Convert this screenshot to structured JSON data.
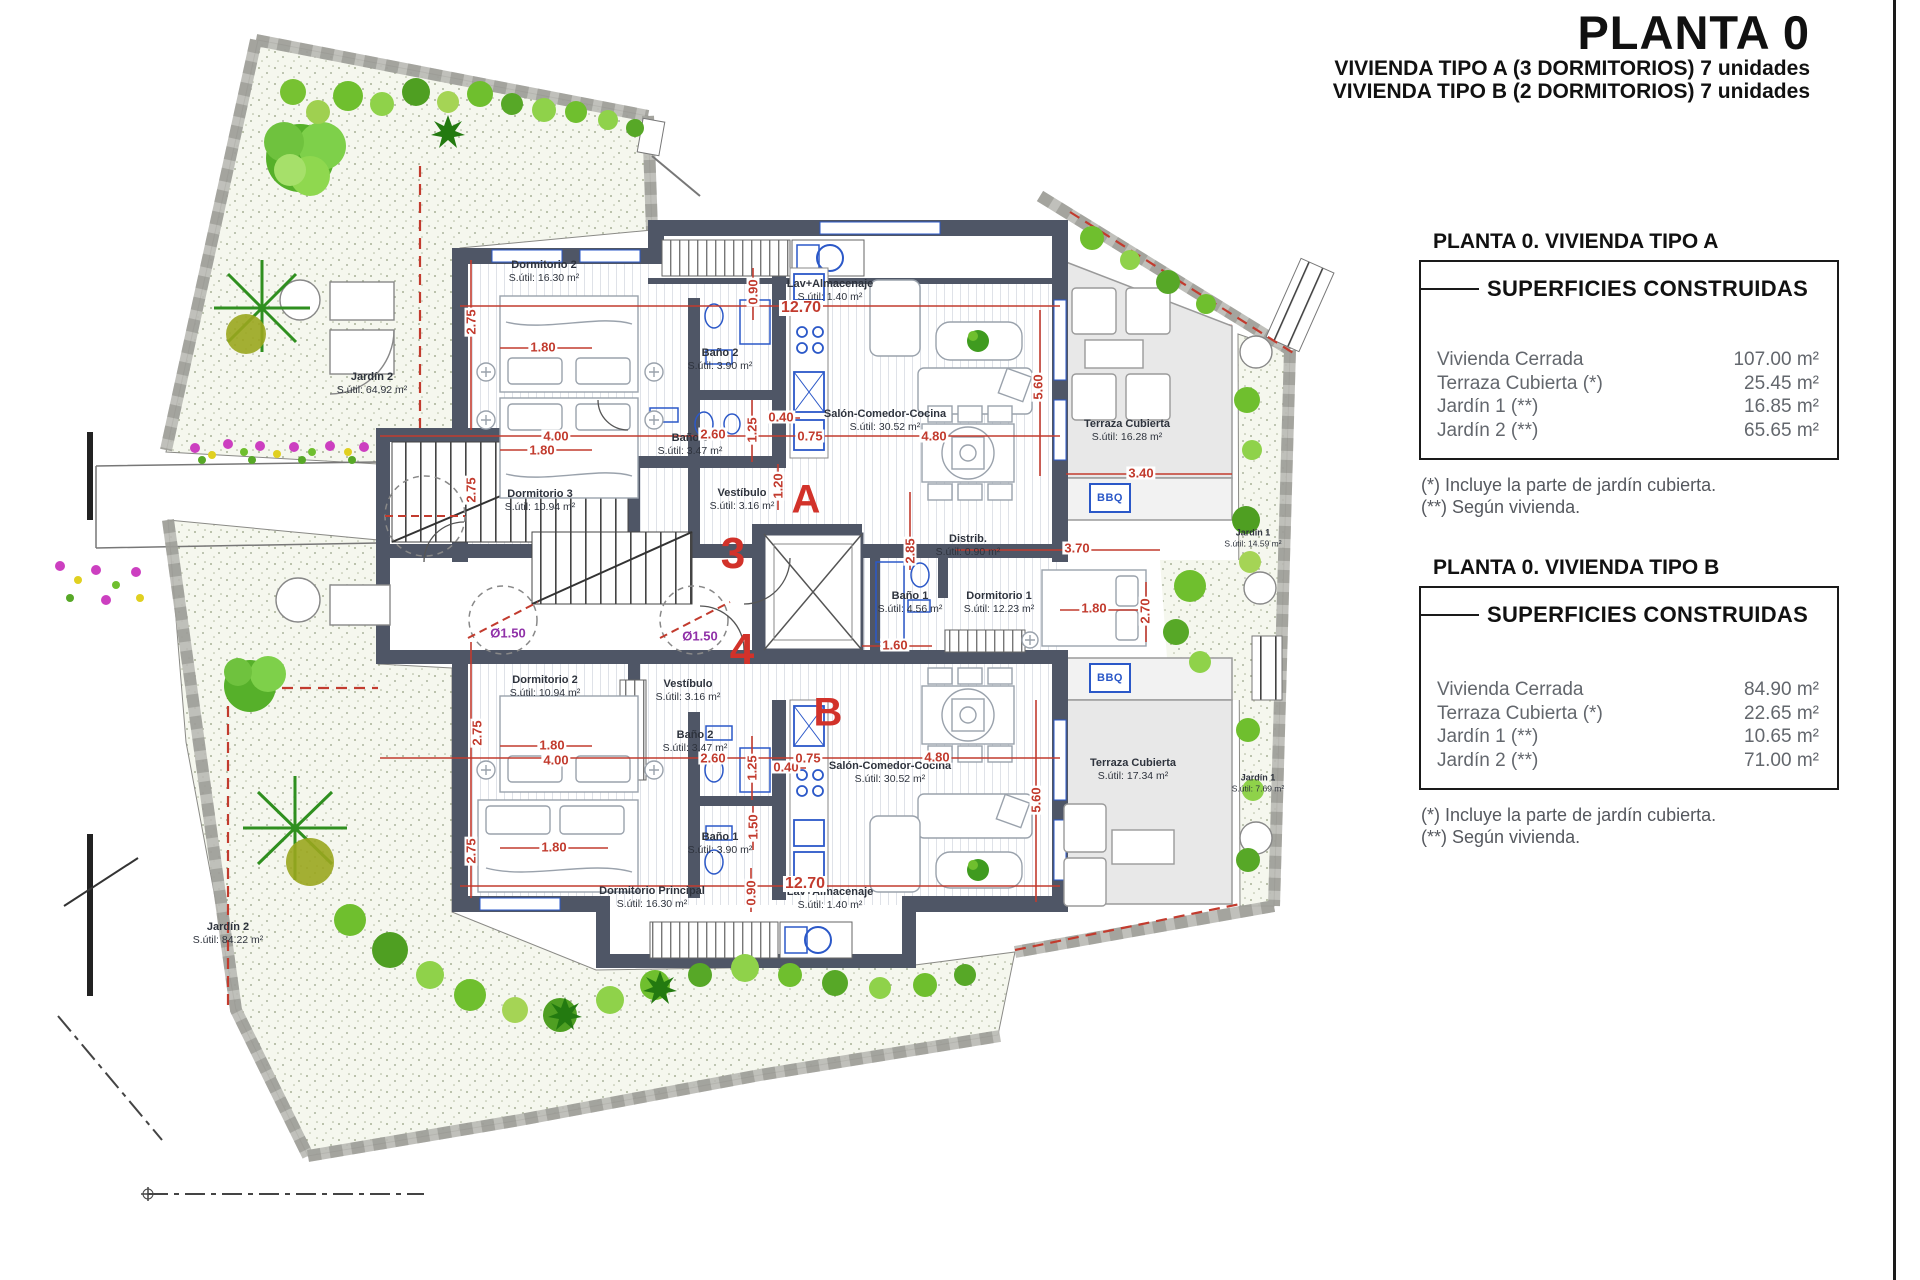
{
  "title_block": {
    "title": "PLANTA 0",
    "subtitle_a": "VIVIENDA TIPO A (3 DORMITORIOS) 7 unidades",
    "subtitle_b": "VIVIENDA TIPO B (2 DORMITORIOS) 7 unidades"
  },
  "panel_a": {
    "header": "PLANTA 0. VIVIENDA TIPO A",
    "box_title": "SUPERFICIES CONSTRUIDAS",
    "rows": [
      {
        "label": "Vivienda Cerrada",
        "value": "107.00 m²"
      },
      {
        "label": "Terraza Cubierta (*)",
        "value": "25.45 m²"
      },
      {
        "label": "Jardín 1 (**)",
        "value": "16.85 m²"
      },
      {
        "label": "Jardín 2 (**)",
        "value": "65.65 m²"
      }
    ],
    "note1": "(*)  Incluye la parte de jardín cubierta.",
    "note2": "(**) Según vivienda."
  },
  "panel_b": {
    "header": "PLANTA 0. VIVIENDA TIPO B",
    "box_title": "SUPERFICIES CONSTRUIDAS",
    "rows": [
      {
        "label": "Vivienda Cerrada",
        "value": "84.90 m²"
      },
      {
        "label": "Terraza Cubierta (*)",
        "value": "22.65 m²"
      },
      {
        "label": "Jardín 1 (**)",
        "value": "10.65 m²"
      },
      {
        "label": "Jardín 2 (**)",
        "value": "71.00 m²"
      }
    ],
    "note1": "(*) Incluye la parte de jardín cubierta.",
    "note2": "(**) Según vivienda."
  },
  "plan": {
    "markers": {
      "unit_a": "A",
      "unit_b": "B",
      "portal_3": "3",
      "portal_4": "4",
      "bbq_a": "BBQ",
      "bbq_b": "BBQ"
    },
    "rooms": [
      {
        "name": "Dormitorio 2",
        "area": "S.útil: 16.30 m²"
      },
      {
        "name": "Lav+Almacenaje",
        "area": "S.útil: 1.40 m²"
      },
      {
        "name": "Baño 2",
        "area": "S.útil: 3.90 m²"
      },
      {
        "name": "Baño 3",
        "area": "S.útil: 3.47 m²"
      },
      {
        "name": "Salón-Comedor-Cocina",
        "area": "S.útil: 30.52 m²"
      },
      {
        "name": "Dormitorio 3",
        "area": "S.útil: 10.94 m²"
      },
      {
        "name": "Vestíbulo",
        "area": "S.útil: 3.16 m²"
      },
      {
        "name": "Terraza Cubierta",
        "area": "S.útil: 16.28 m²"
      },
      {
        "name": "Distrib.",
        "area": "S.útil: 0.90 m²"
      },
      {
        "name": "Baño 1",
        "area": "S.útil: 4.56 m²"
      },
      {
        "name": "Dormitorio 1",
        "area": "S.útil: 12.23 m²"
      },
      {
        "name": "Jardín 1",
        "area": "S.útil: 14.59 m²"
      },
      {
        "name": "Jardín 2",
        "area": "S.útil: 64.92 m²"
      },
      {
        "name": "Dormitorio 2",
        "area": "S.útil: 10.94 m²"
      },
      {
        "name": "Vestíbulo",
        "area": "S.útil: 3.16 m²"
      },
      {
        "name": "Baño 2",
        "area": "S.útil: 3.47 m²"
      },
      {
        "name": "Baño 1",
        "area": "S.útil: 3.90 m²"
      },
      {
        "name": "Salón-Comedor-Cocina",
        "area": "S.útil: 30.52 m²"
      },
      {
        "name": "Terraza Cubierta",
        "area": "S.útil: 17.34 m²"
      },
      {
        "name": "Dormitorio Principal",
        "area": "S.útil: 16.30 m²"
      },
      {
        "name": "Lav+Almacenaje",
        "area": "S.útil: 1.40 m²"
      },
      {
        "name": "Jardín 1",
        "area": "S.útil: 7.69 m²"
      },
      {
        "name": "Jardín 2",
        "area": "S.útil: 84.22 m²"
      }
    ],
    "dims": [
      "2.75",
      "1.80",
      "4.00",
      "1.80",
      "2.75",
      "2.60",
      "1.25",
      "0.40",
      "0.75",
      "1.20",
      "0.90",
      "12.70",
      "4.80",
      "5.60",
      "3.40",
      "2.85",
      "3.70",
      "1.80",
      "2.70",
      "1.60",
      "2.75",
      "1.80",
      "4.00",
      "2.60",
      "1.25",
      "0.40",
      "0.75",
      "1.50",
      "1.80",
      "2.75",
      "0.90",
      "12.70",
      "4.80",
      "5.60",
      "Ø1.50",
      "Ø1.50"
    ]
  },
  "colors": {
    "wall": "#4f5666",
    "dimension_red": "#c23b2e",
    "marker_red": "#d2322a",
    "fixture_blue": "#2b58c8",
    "turning_circle_purple": "#9031a8",
    "terrace_gray": "#e8e8e8",
    "garden_base": "#f5f7ee",
    "tree_green": "#56b02a"
  }
}
